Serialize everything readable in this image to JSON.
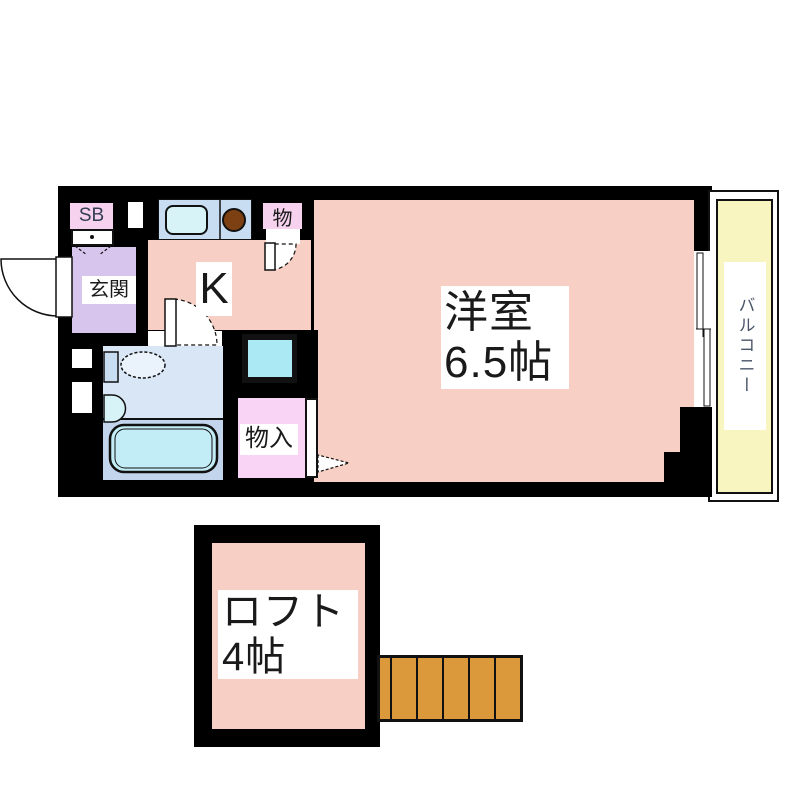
{
  "plan": {
    "type": "apartment-floor-plan",
    "labels": {
      "shoe_box": "SB",
      "entrance": "玄関",
      "kitchen": "K",
      "storage": "物",
      "closet": "物入",
      "main_room_name": "洋室",
      "main_room_size": "6.5帖",
      "balcony": "バルコニー",
      "loft_name": "ロフト",
      "loft_size": "4帖"
    }
  },
  "colors": {
    "wall": "#000000",
    "room_pink": "#f7cfc4",
    "entrance_purple": "#d8c5ee",
    "label_pink": "#f6d2ee",
    "closet_pink": "#f9d4f4",
    "counter_blue": "#c8dcf2",
    "sink_cyan": "#d8f3f8",
    "washer_cyan": "#abeaf4",
    "bath_upper": "#d8e6f5",
    "bath_lower": "#c3d5ec",
    "tub_cyan": "#c2ecf6",
    "balcony_yellow": "#f8f5c0",
    "stairs_orange": "#dc993c",
    "burner_brown": "#7c4012",
    "label_text": "#1a1a1a",
    "balcony_text": "#4a5568"
  }
}
